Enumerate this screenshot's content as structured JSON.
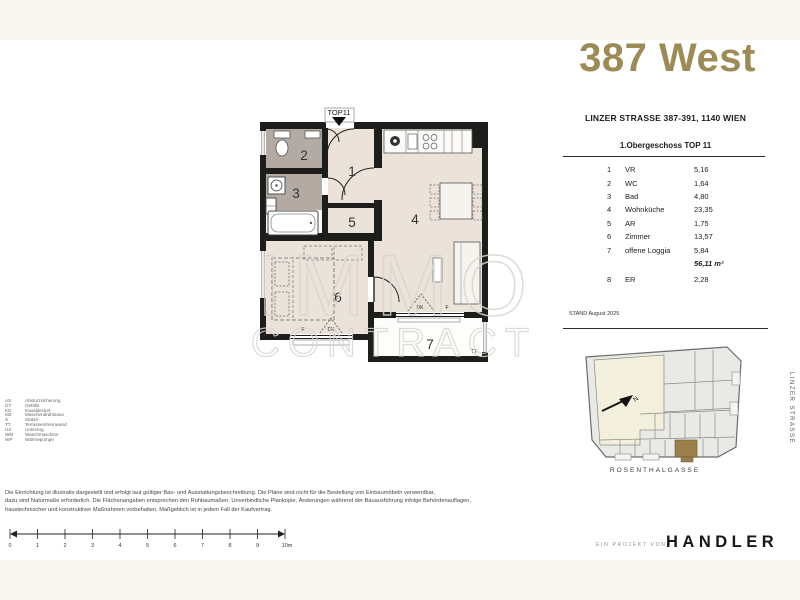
{
  "colors": {
    "accent_gold": "#9d8b55",
    "band_cream": "#f8f6ef",
    "floor_beige": "#ebe2d9",
    "floor_taupe": "#b3aaa3",
    "wall_black": "#1d1d1b",
    "highlight_unit": "#9a7f4a"
  },
  "header": {
    "project_title": "387 West"
  },
  "info_panel": {
    "address": "LINZER STRASSE 387-391, 1140 WIEN",
    "floor_title": "1.Obergeschoss TOP 11",
    "rooms": [
      {
        "num": "1",
        "name": "VR",
        "area": "5,16"
      },
      {
        "num": "2",
        "name": "WC",
        "area": "1,64"
      },
      {
        "num": "3",
        "name": "Bad",
        "area": "4,80"
      },
      {
        "num": "4",
        "name": "Wohnküche",
        "area": "23,35"
      },
      {
        "num": "5",
        "name": "AR",
        "area": "1,75"
      },
      {
        "num": "6",
        "name": "Zimmer",
        "area": "13,57"
      },
      {
        "num": "7",
        "name": "offene Loggia",
        "area": "5,84"
      }
    ],
    "total_area": "56,11 m²",
    "extra_room": {
      "num": "8",
      "name": "ER",
      "area": "2,28"
    },
    "stand_note": "STAND August 2025"
  },
  "floor_plan": {
    "unit_label": "TOP11",
    "room_numbers": [
      "1",
      "2",
      "3",
      "4",
      "5",
      "6",
      "7"
    ],
    "window_labels": {
      "dk": "DK",
      "f": "F",
      "tt": "TT"
    },
    "watermark": {
      "line1": "IMMO",
      "line2": "CONTRACT"
    }
  },
  "site_map": {
    "north_label": "N",
    "street_right": "LINZER STRASSE",
    "street_bottom": "ROSENTHALGASSE"
  },
  "legend": {
    "items": [
      {
        "abbr": "AS",
        "label": "Absturzsicherung"
      },
      {
        "abbr": "GT",
        "label": "Gefälle"
      },
      {
        "abbr": "KD",
        "label": "Kanaldeckel"
      },
      {
        "abbr": "MZ",
        "label": "Maschendrahtzaun"
      },
      {
        "abbr": "S",
        "label": "Stütze"
      },
      {
        "abbr": "TT",
        "label": "Terrassentrennwand"
      },
      {
        "abbr": "UZ",
        "label": "Unterzug"
      },
      {
        "abbr": "WM",
        "label": "Waschmaschine"
      },
      {
        "abbr": "WP",
        "label": "Wärmepumpe"
      }
    ]
  },
  "disclaimer": {
    "line1": "Die Einrichtung ist illustrativ dargestellt und erfolgt laut gültiger Bau- und Ausstattungsbeschreibung. Die Pläne sind nicht für die Bestellung von Einbaumöbeln verwendbar,",
    "line2": "dazu sind Naturmaße erforderlich. Die Flächenangaben entsprechen den Rohbaumaßen. Unverbindliche Plankopie, Änderungen während der Bauausführung infolge Behördenauflagen,",
    "line3": "haustechnischer und konstruktiver Maßnahmen vorbehalten. Maßgeblich ist in jedem Fall der Kaufvertrag."
  },
  "scale_bar": {
    "labels": [
      "0",
      "1",
      "2",
      "3",
      "4",
      "5",
      "6",
      "7",
      "8",
      "9",
      "10m"
    ]
  },
  "footer": {
    "project_label": "EIN PROJEKT VON",
    "brand": "HANDLER"
  }
}
